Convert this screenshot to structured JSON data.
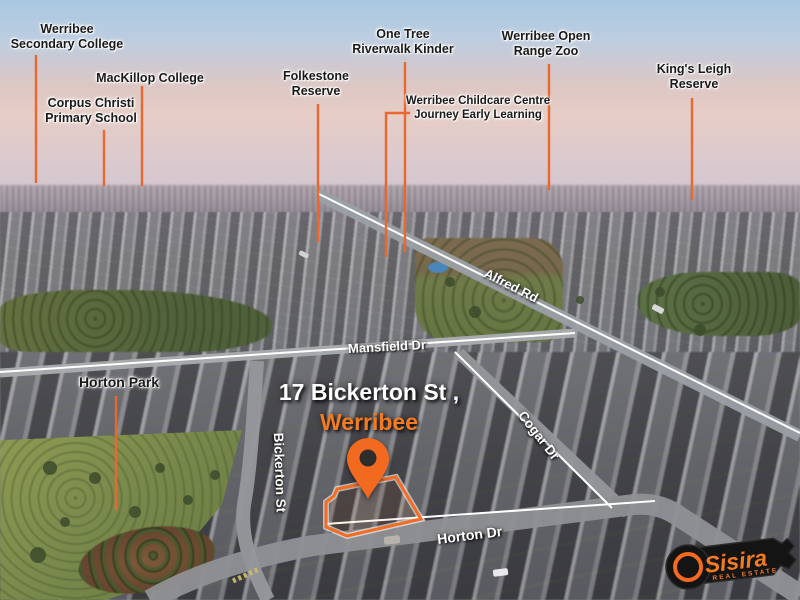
{
  "poi": {
    "werribee_secondary_college": "Werribee\nSecondary College",
    "mackillop_college": "MacKillop College",
    "corpus_christi": "Corpus Christi\nPrimary School",
    "folkestone_reserve": "Folkestone\nReserve",
    "one_tree_kinder": "One Tree\nRiverwalk Kinder",
    "werribee_childcare": "Werribee Childcare Centre\nJourney Early Learning",
    "werribee_zoo": "Werribee Open\nRange Zoo",
    "kings_leigh_reserve": "King's Leigh\nReserve",
    "horton_park": "Horton Park"
  },
  "roads": {
    "alfred_rd": "Alfred Rd",
    "mansfield_dr": "Mansfield Dr",
    "bickerton_st": "Bickerton St",
    "cogar_dr": "Cogar Dr",
    "horton_dr": "Horton Dr"
  },
  "property": {
    "address": "17 Bickerton St ,",
    "suburb": "Werribee"
  },
  "logo": {
    "brand": "Sisira",
    "tagline": "REAL ESTATE"
  },
  "colors": {
    "accent_orange": "#F26C23",
    "callout_line": "#E8682F",
    "suburb_text": "#F47B20",
    "road_line": "#FFFFFF",
    "label_text": "#1A1A1A"
  }
}
